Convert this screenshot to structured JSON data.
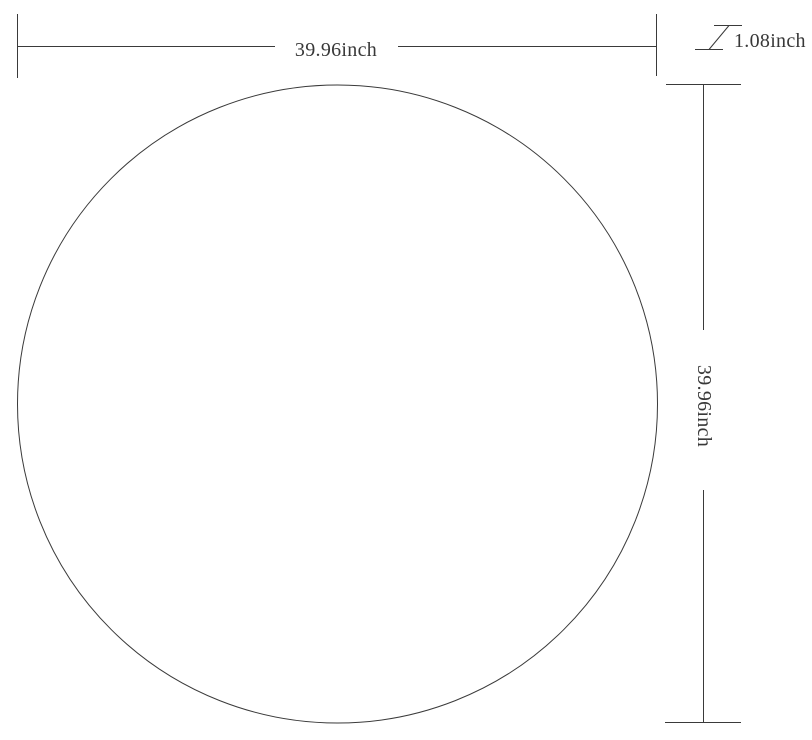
{
  "diagram": {
    "shape": "circle",
    "dimensions": {
      "width": {
        "label": "39.96inch",
        "value": 39.96,
        "unit": "inch"
      },
      "height": {
        "label": "39.96inch",
        "value": 39.96,
        "unit": "inch"
      },
      "thickness": {
        "label": "1.08inch",
        "value": 1.08,
        "unit": "inch"
      }
    }
  },
  "colors": {
    "line": "#3a3a3a",
    "text": "#383838",
    "background": "#ffffff"
  }
}
